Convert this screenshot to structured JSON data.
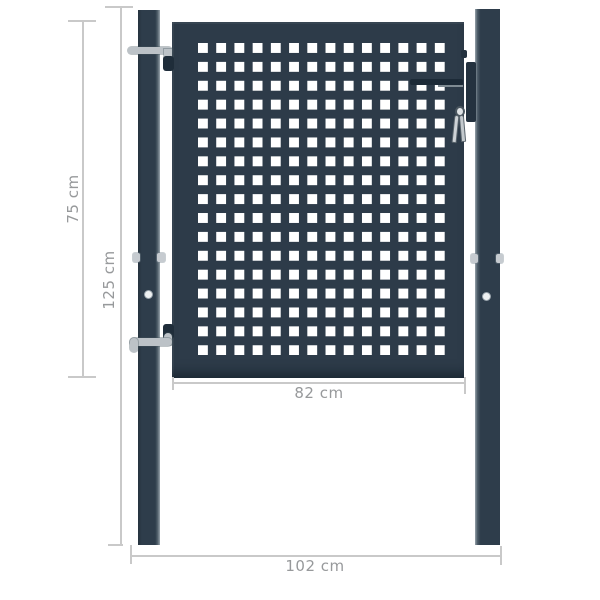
{
  "diagram": {
    "type": "product-dimension-diagram",
    "subject": "perforated garden fence gate with two posts, hinges, lock and keys",
    "finish_color_name": "anthracite"
  },
  "colors": {
    "anthracite": "#2d3b49",
    "hardware_gray": "#bcc2c7",
    "hinge_dark": "#1f2d3a",
    "dimension_line": "#c9c9c9",
    "dimension_text": "#97999b",
    "hole": "#ffffff",
    "background": "#ffffff"
  },
  "perforation_grid": {
    "columns": 14,
    "rows": 17,
    "hole_shape": "square"
  },
  "dimensions": {
    "leaf_height": {
      "label": "75 cm",
      "orientation": "vertical"
    },
    "post_height": {
      "label": "125 cm",
      "orientation": "vertical"
    },
    "leaf_width": {
      "label": "82 cm",
      "orientation": "horizontal"
    },
    "total_width": {
      "label": "102 cm",
      "orientation": "horizontal"
    }
  }
}
